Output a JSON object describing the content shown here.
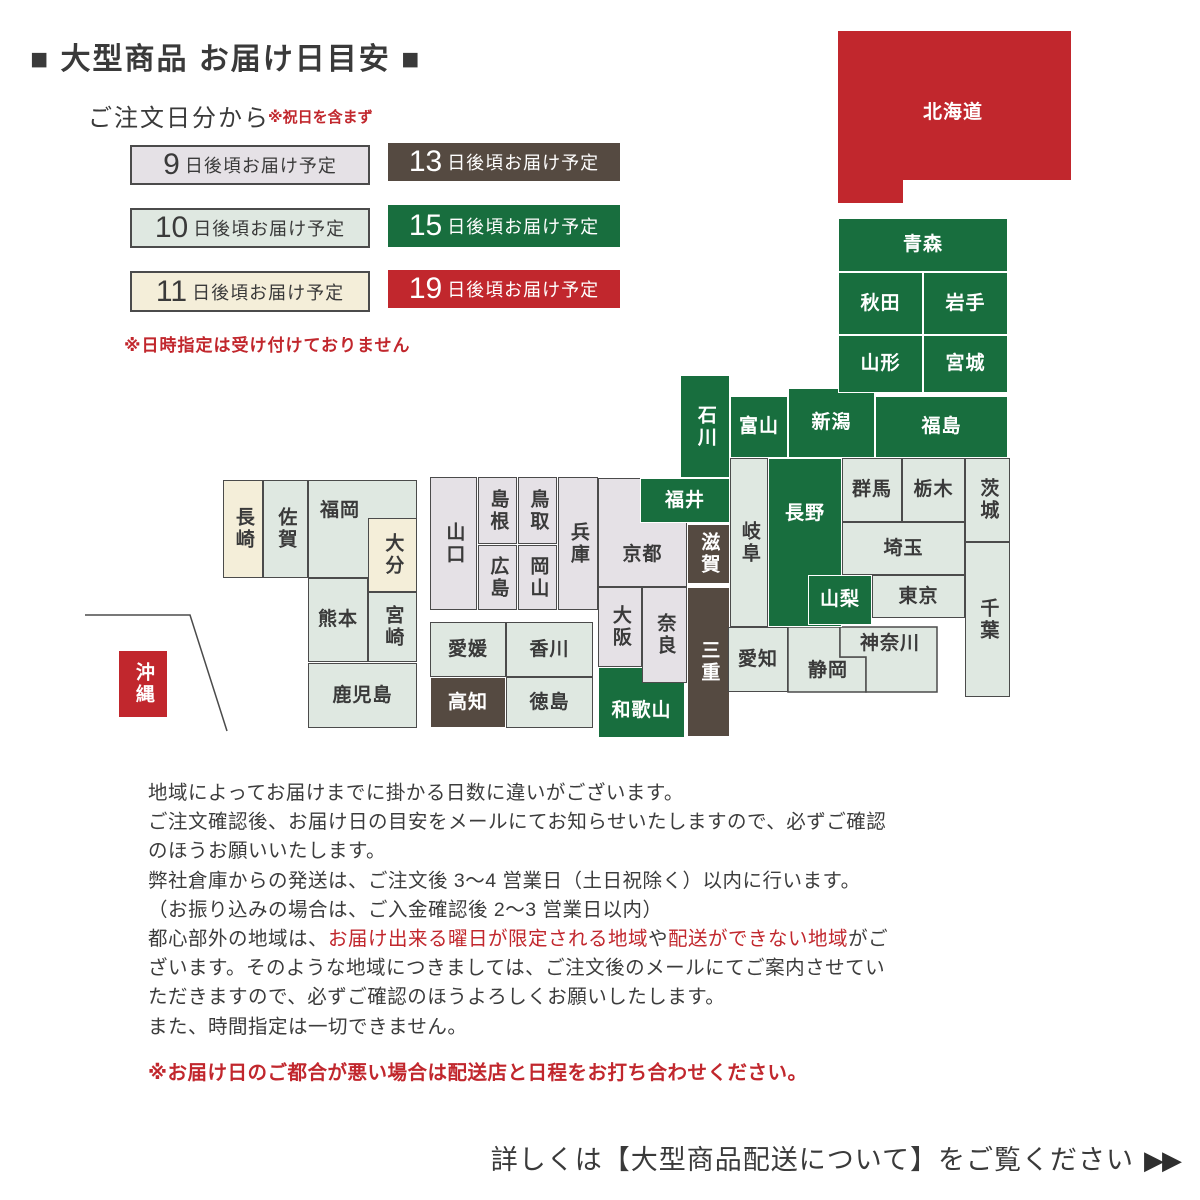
{
  "title": "■ 大型商品 お届け日目安 ■",
  "legend": {
    "heading": "ご注文日分から",
    "holiday_note": "※祝日を含まず",
    "suffix": "日後頃お届け予定",
    "datetime_note": "※日時指定は受け付けておりません",
    "items": [
      {
        "num": "9",
        "cls": "c9",
        "x": 130,
        "y": 145,
        "w": 240,
        "h": 40
      },
      {
        "num": "10",
        "cls": "c10",
        "x": 130,
        "y": 208,
        "w": 240,
        "h": 40
      },
      {
        "num": "11",
        "cls": "c11",
        "x": 130,
        "y": 271,
        "w": 240,
        "h": 41
      },
      {
        "num": "13",
        "cls": "c13",
        "x": 388,
        "y": 143,
        "w": 232,
        "h": 38
      },
      {
        "num": "15",
        "cls": "c15",
        "x": 388,
        "y": 205,
        "w": 232,
        "h": 42
      },
      {
        "num": "19",
        "cls": "c19",
        "x": 388,
        "y": 270,
        "w": 232,
        "h": 38
      }
    ]
  },
  "colors": {
    "days9": "#e5e1e6",
    "days10": "#dfe8e1",
    "days11": "#f4eed9",
    "days13": "#554a41",
    "days15": "#186e3e",
    "days19": "#c1272d",
    "box_border": "#4b4b4b",
    "text": "#3a3a3a",
    "accent_red": "#c1272d"
  },
  "map": {
    "prefectures": [
      {
        "id": "nagasaki",
        "label": "長崎",
        "days": 11,
        "x": 223,
        "y": 480,
        "w": 40,
        "h": 98,
        "dir": "v"
      },
      {
        "id": "saga",
        "label": "佐賀",
        "days": 10,
        "x": 263,
        "y": 480,
        "w": 45,
        "h": 98,
        "dir": "v"
      },
      {
        "id": "fukuoka",
        "label": "福岡",
        "days": 10,
        "x": 308,
        "y": 480,
        "w": 109,
        "h": 98,
        "dir": "h",
        "lbox": [
          308,
          480,
          64,
          62
        ]
      },
      {
        "id": "oita",
        "label": "大分",
        "days": 11,
        "x": 368,
        "y": 518,
        "w": 49,
        "h": 74,
        "dir": "v"
      },
      {
        "id": "kumamoto",
        "label": "熊本",
        "days": 10,
        "x": 308,
        "y": 578,
        "w": 60,
        "h": 84,
        "dir": "h"
      },
      {
        "id": "miyazaki",
        "label": "宮崎",
        "days": 10,
        "x": 368,
        "y": 592,
        "w": 49,
        "h": 70,
        "dir": "v"
      },
      {
        "id": "kagoshima",
        "label": "鹿児島",
        "days": 10,
        "x": 308,
        "y": 663,
        "w": 109,
        "h": 65,
        "dir": "h"
      },
      {
        "id": "okinawa",
        "label": "沖縄",
        "days": 19,
        "x": 118,
        "y": 650,
        "w": 50,
        "h": 68,
        "dir": "v"
      },
      {
        "id": "ehime",
        "label": "愛媛",
        "days": 10,
        "x": 430,
        "y": 622,
        "w": 76,
        "h": 55,
        "dir": "h"
      },
      {
        "id": "kagawa",
        "label": "香川",
        "days": 10,
        "x": 506,
        "y": 622,
        "w": 87,
        "h": 55,
        "dir": "h"
      },
      {
        "id": "kochi",
        "label": "高知",
        "days": 13,
        "x": 430,
        "y": 677,
        "w": 76,
        "h": 51,
        "dir": "h"
      },
      {
        "id": "tokushima",
        "label": "徳島",
        "days": 10,
        "x": 506,
        "y": 677,
        "w": 87,
        "h": 51,
        "dir": "h"
      },
      {
        "id": "yamaguchi",
        "label": "山口",
        "days": 9,
        "x": 430,
        "y": 477,
        "w": 47,
        "h": 133,
        "dir": "v"
      },
      {
        "id": "shimane",
        "label": "島根",
        "days": 9,
        "x": 478,
        "y": 477,
        "w": 39,
        "h": 67,
        "dir": "v"
      },
      {
        "id": "tottori",
        "label": "鳥取",
        "days": 9,
        "x": 518,
        "y": 477,
        "w": 39,
        "h": 67,
        "dir": "v"
      },
      {
        "id": "hiroshima",
        "label": "広島",
        "days": 9,
        "x": 478,
        "y": 545,
        "w": 39,
        "h": 65,
        "dir": "v"
      },
      {
        "id": "okayama",
        "label": "岡山",
        "days": 9,
        "x": 518,
        "y": 545,
        "w": 39,
        "h": 65,
        "dir": "v"
      },
      {
        "id": "hyogo",
        "label": "兵庫",
        "days": 9,
        "x": 558,
        "y": 477,
        "w": 40,
        "h": 133,
        "dir": "v"
      },
      {
        "id": "kyoto",
        "label": "京都",
        "days": 9,
        "x": 598,
        "y": 478,
        "w": 89,
        "h": 109,
        "dir": "h",
        "lbox": [
          598,
          524,
          89,
          62
        ]
      },
      {
        "id": "osaka",
        "label": "大阪",
        "days": 9,
        "x": 598,
        "y": 587,
        "w": 44,
        "h": 80,
        "dir": "v"
      },
      {
        "id": "wakayama",
        "label": "和歌山",
        "days": 15,
        "x": 598,
        "y": 667,
        "w": 87,
        "h": 71,
        "dir": "h",
        "lbox": [
          598,
          683,
          87,
          55
        ]
      },
      {
        "id": "nara",
        "label": "奈良",
        "days": 9,
        "x": 642,
        "y": 587,
        "w": 45,
        "h": 96,
        "dir": "v"
      },
      {
        "id": "fukui",
        "label": "福井",
        "days": 15,
        "x": 640,
        "y": 478,
        "w": 90,
        "h": 45,
        "dir": "h"
      },
      {
        "id": "shiga",
        "label": "滋賀",
        "days": 13,
        "x": 687,
        "y": 524,
        "w": 43,
        "h": 60,
        "dir": "v"
      },
      {
        "id": "mie",
        "label": "三重",
        "days": 13,
        "x": 687,
        "y": 587,
        "w": 43,
        "h": 150,
        "dir": "v"
      },
      {
        "id": "ishikawa",
        "label": "石川",
        "days": 15,
        "x": 680,
        "y": 375,
        "w": 50,
        "h": 103,
        "dir": "v"
      },
      {
        "id": "toyama",
        "label": "富山",
        "days": 15,
        "x": 730,
        "y": 396,
        "w": 58,
        "h": 62,
        "dir": "h"
      },
      {
        "id": "niigata",
        "label": "新潟",
        "days": 15,
        "x": 788,
        "y": 388,
        "w": 87,
        "h": 70,
        "dir": "h"
      },
      {
        "id": "gifu",
        "label": "岐阜",
        "days": 10,
        "x": 730,
        "y": 458,
        "w": 38,
        "h": 169,
        "dir": "v"
      },
      {
        "id": "nagano",
        "label": "長野",
        "days": 15,
        "x": 768,
        "y": 458,
        "w": 74,
        "h": 169,
        "dir": "h",
        "lbox": [
          768,
          458,
          74,
          112
        ]
      },
      {
        "id": "yamanashi",
        "label": "山梨",
        "days": 15,
        "x": 808,
        "y": 575,
        "w": 64,
        "h": 50,
        "dir": "h"
      },
      {
        "id": "aichi",
        "label": "愛知",
        "days": 10,
        "x": 728,
        "y": 627,
        "w": 60,
        "h": 65,
        "dir": "h"
      },
      {
        "id": "fukushima",
        "label": "福島",
        "days": 15,
        "x": 875,
        "y": 396,
        "w": 133,
        "h": 62,
        "dir": "h"
      },
      {
        "id": "gunma",
        "label": "群馬",
        "days": 10,
        "x": 842,
        "y": 458,
        "w": 60,
        "h": 64,
        "dir": "h"
      },
      {
        "id": "tochigi",
        "label": "栃木",
        "days": 10,
        "x": 902,
        "y": 458,
        "w": 63,
        "h": 64,
        "dir": "h"
      },
      {
        "id": "ibaraki",
        "label": "茨城",
        "days": 10,
        "x": 965,
        "y": 458,
        "w": 45,
        "h": 84,
        "dir": "v"
      },
      {
        "id": "saitama",
        "label": "埼玉",
        "days": 10,
        "x": 842,
        "y": 522,
        "w": 123,
        "h": 53,
        "dir": "h"
      },
      {
        "id": "tokyo",
        "label": "東京",
        "days": 10,
        "x": 872,
        "y": 575,
        "w": 93,
        "h": 43,
        "dir": "h"
      },
      {
        "id": "chiba",
        "label": "千葉",
        "days": 10,
        "x": 965,
        "y": 542,
        "w": 45,
        "h": 155,
        "dir": "v"
      },
      {
        "id": "aomori",
        "label": "青森",
        "days": 15,
        "x": 838,
        "y": 218,
        "w": 170,
        "h": 54,
        "dir": "h"
      },
      {
        "id": "akita",
        "label": "秋田",
        "days": 15,
        "x": 838,
        "y": 272,
        "w": 85,
        "h": 63,
        "dir": "h"
      },
      {
        "id": "iwate",
        "label": "岩手",
        "days": 15,
        "x": 923,
        "y": 272,
        "w": 85,
        "h": 63,
        "dir": "h"
      },
      {
        "id": "yamagata",
        "label": "山形",
        "days": 15,
        "x": 838,
        "y": 335,
        "w": 85,
        "h": 58,
        "dir": "h"
      },
      {
        "id": "miyagi",
        "label": "宮城",
        "days": 15,
        "x": 923,
        "y": 335,
        "w": 85,
        "h": 58,
        "dir": "h"
      }
    ],
    "polygons": [
      {
        "id": "hokkaido",
        "label": "北海道",
        "days": 19,
        "points": [
          [
            838,
            31
          ],
          [
            1071,
            31
          ],
          [
            1071,
            180
          ],
          [
            903,
            180
          ],
          [
            903,
            203
          ],
          [
            838,
            203
          ]
        ],
        "stroke": false
      },
      {
        "id": "shizuoka",
        "label": "静岡",
        "days": 10,
        "points": [
          [
            788,
            627
          ],
          [
            840,
            627
          ],
          [
            840,
            657
          ],
          [
            866,
            657
          ],
          [
            866,
            692
          ],
          [
            788,
            692
          ]
        ],
        "stroke": true
      },
      {
        "id": "kanagawa",
        "label": "神奈川",
        "days": 10,
        "points": [
          [
            840,
            627
          ],
          [
            937,
            627
          ],
          [
            937,
            692
          ],
          [
            866,
            692
          ],
          [
            866,
            657
          ],
          [
            840,
            657
          ]
        ],
        "stroke": true
      }
    ],
    "float_labels": [
      {
        "id": "hokkaido",
        "text": "北海道",
        "x": 898,
        "y": 98,
        "w": 110,
        "h": 30,
        "tone": "light"
      },
      {
        "id": "shizuoka",
        "text": "静岡",
        "x": 790,
        "y": 652,
        "w": 76,
        "h": 38,
        "tone": "dark"
      },
      {
        "id": "kanagawa",
        "text": "神奈川",
        "x": 844,
        "y": 628,
        "w": 92,
        "h": 32,
        "tone": "dark"
      }
    ],
    "okinawa_boundary": [
      [
        85,
        615
      ],
      [
        190,
        615
      ],
      [
        227,
        731
      ]
    ]
  },
  "notes": {
    "lines": [
      [
        {
          "t": "地域によってお届けまでに掛かる日数に違いがございます。"
        }
      ],
      [
        {
          "t": "ご注文確認後、お届け日の目安をメールにてお知らせいたしますので、必ずご確認"
        }
      ],
      [
        {
          "t": "のほうお願いいたします。"
        }
      ],
      [
        {
          "t": "弊社倉庫からの発送は、ご注文後 3〜4 営業日（土日祝除く）以内に行います。"
        }
      ],
      [
        {
          "t": "（お振り込みの場合は、ご入金確認後 2〜3 営業日以内）"
        }
      ],
      [
        {
          "t": "都心部外の地域は、"
        },
        {
          "t": "お届け出来る曜日が限定される地域",
          "red": true
        },
        {
          "t": "や"
        },
        {
          "t": "配送ができない地域",
          "red": true
        },
        {
          "t": "がご"
        }
      ],
      [
        {
          "t": "ざいます。そのような地域につきましては、ご注文後のメールにてご案内させてい"
        }
      ],
      [
        {
          "t": "ただきますので、必ずご確認のほうよろしくお願いしたします。"
        }
      ],
      [
        {
          "t": "また、時間指定は一切できません。"
        }
      ]
    ],
    "warn": "※お届け日のご都合が悪い場合は配送店と日程をお打ち合わせください。"
  },
  "cta": {
    "text": "詳しくは【大型商品配送について】をご覧ください",
    "arrows": "▶▶"
  }
}
